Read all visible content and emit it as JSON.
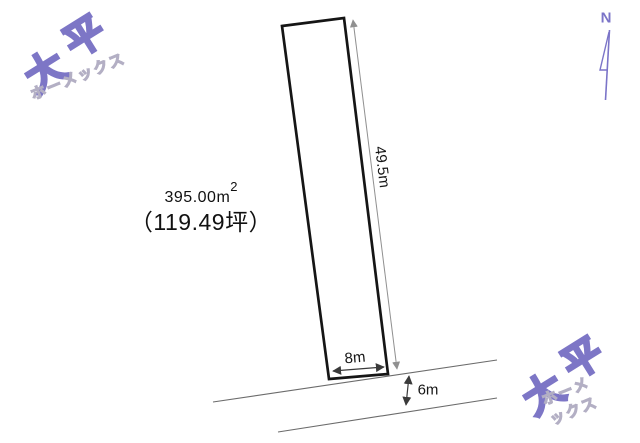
{
  "diagram": {
    "title_hint": "land-plot-survey-diagram",
    "background": "#ffffff"
  },
  "compass": {
    "label": "N"
  },
  "watermark": {
    "char1": "大",
    "char2": "平",
    "subtext": "ホーメックス",
    "outline_color": "#7d76c6",
    "subtext_outline_color": "#b3afc4"
  },
  "parcel": {
    "area_value": "395.00m",
    "area_superscript": "2",
    "area_tsubo": "（119.49坪）"
  },
  "dimensions": {
    "side_length": "49.5m",
    "frontage": "8m",
    "road_width": "6m"
  },
  "colors": {
    "parcel_outline": "#151515",
    "road_line": "#6b6b6b",
    "dim_line_side": "#909090",
    "dim_line_dark": "#3a3a3a",
    "brand_purple": "#7b74c8"
  }
}
